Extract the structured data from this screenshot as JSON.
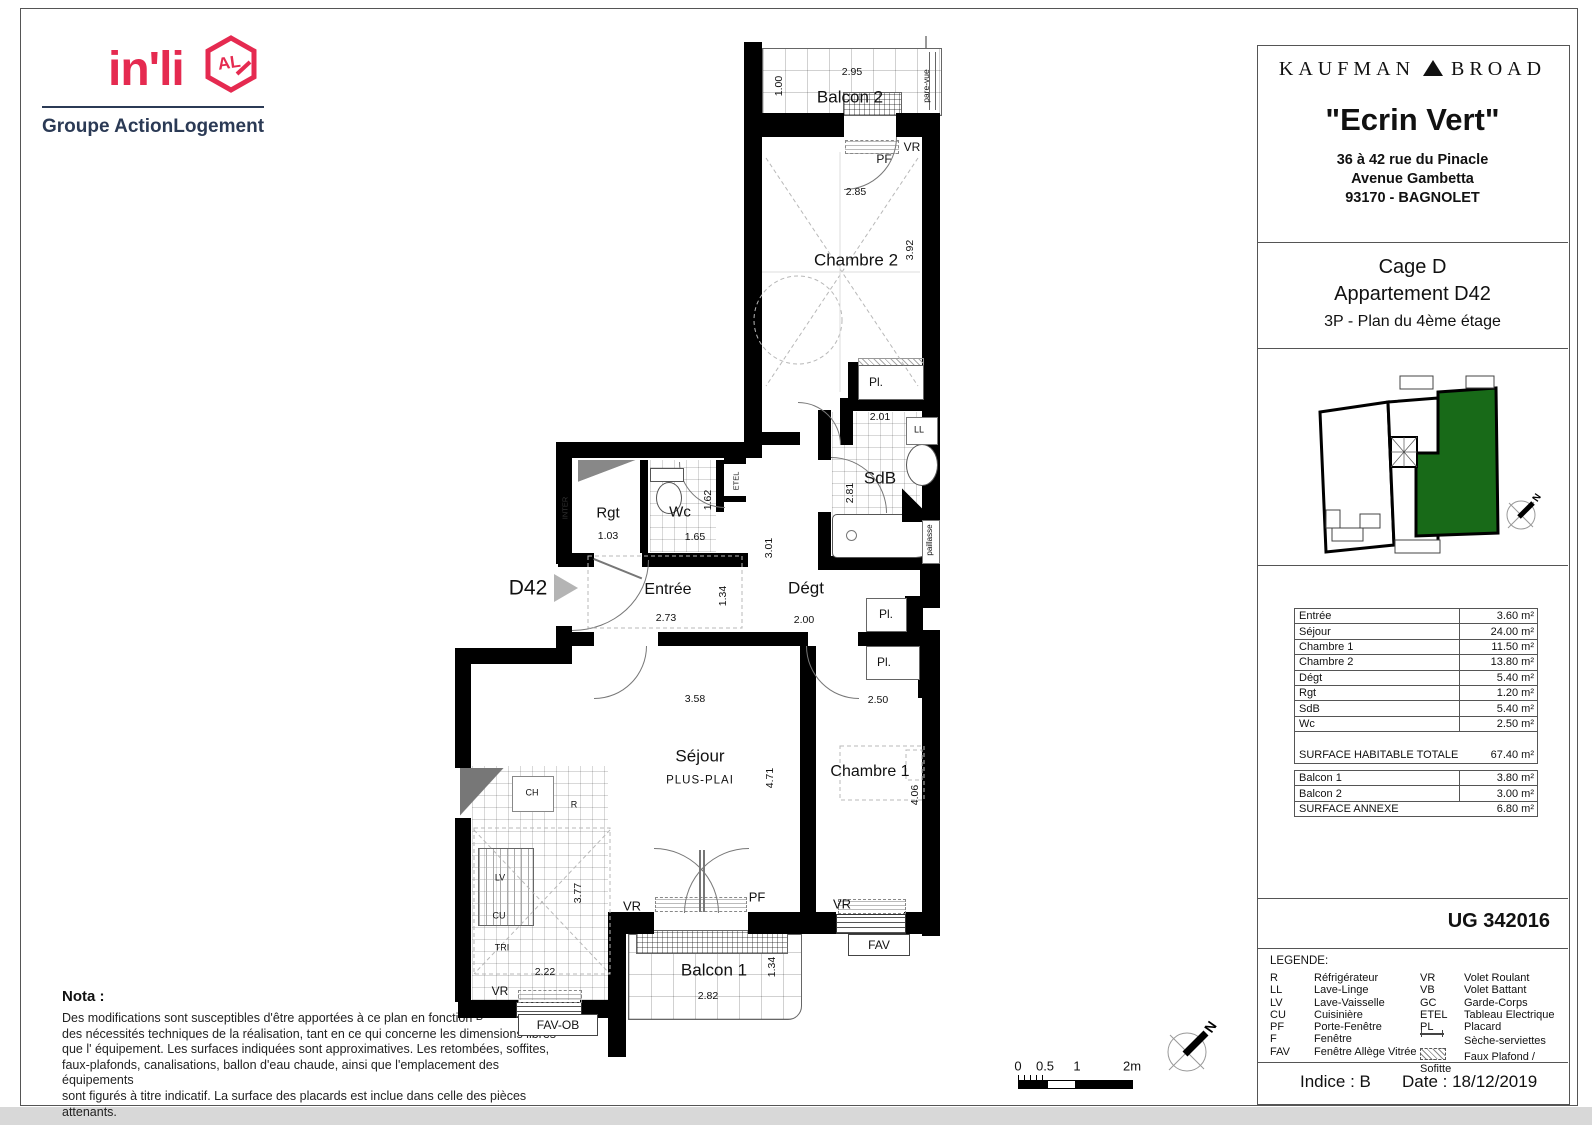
{
  "branding": {
    "inli": "in'li",
    "inli_badge": "AL",
    "inli_sub": "Groupe ActionLogement",
    "accent_pink": "#e52a50",
    "navy": "#2b3a55"
  },
  "header": {
    "developer_left": "KAUFMAN",
    "developer_right": "BROAD",
    "project": "\"Ecrin Vert\"",
    "address1": "36 à 42 rue du Pinacle",
    "address2": "Avenue Gambetta",
    "address3": "93170 - BAGNOLET"
  },
  "unit": {
    "cage": "Cage D",
    "apartment": "Appartement D42",
    "floor": "3P - Plan du 4ème étage"
  },
  "key_plan": {
    "north": "N",
    "highlight_green": "#186a18"
  },
  "surfaces": {
    "rows": [
      {
        "label": "Entrée",
        "value": "3.60 m²"
      },
      {
        "label": "Séjour",
        "value": "24.00 m²"
      },
      {
        "label": "Chambre 1",
        "value": "11.50 m²"
      },
      {
        "label": "Chambre 2",
        "value": "13.80 m²"
      },
      {
        "label": "Dégt",
        "value": "5.40 m²"
      },
      {
        "label": "Rgt",
        "value": "1.20 m²"
      },
      {
        "label": "SdB",
        "value": "5.40 m²"
      },
      {
        "label": "Wc",
        "value": "2.50 m²"
      }
    ],
    "total": {
      "label": "SURFACE HABITABLE TOTALE",
      "value": "67.40 m²"
    },
    "annexe_rows": [
      {
        "label": "Balcon 1",
        "value": "3.80 m²"
      },
      {
        "label": "Balcon 2",
        "value": "3.00 m²"
      }
    ],
    "annexe_total": {
      "label": "SURFACE ANNEXE",
      "value": "6.80 m²"
    }
  },
  "reference": "UG 342016",
  "legend": {
    "title": "LEGENDE:",
    "left": [
      {
        "abbr": "R",
        "label": "Réfrigérateur"
      },
      {
        "abbr": "LL",
        "label": "Lave-Linge"
      },
      {
        "abbr": "LV",
        "label": "Lave-Vaisselle"
      },
      {
        "abbr": "CU",
        "label": "Cuisinière"
      },
      {
        "abbr": "PF",
        "label": "Porte-Fenêtre"
      },
      {
        "abbr": "F",
        "label": "Fenêtre"
      },
      {
        "abbr": "FAV",
        "label": "Fenêtre Allège Vitrée"
      }
    ],
    "right": [
      {
        "abbr": "VR",
        "label": "Volet Roulant"
      },
      {
        "abbr": "VB",
        "label": "Volet Battant"
      },
      {
        "abbr": "GC",
        "label": "Garde-Corps"
      },
      {
        "abbr": "ETEL",
        "label": "Tableau Electrique"
      },
      {
        "abbr": "PL",
        "label": "Placard"
      },
      {
        "abbr": "",
        "label": "Sèche-serviettes"
      },
      {
        "abbr": "",
        "label": "Faux Plafond / Sofitte"
      }
    ]
  },
  "footer": {
    "indice": "Indice : B",
    "date": "Date : 18/12/2019"
  },
  "nota": {
    "title": "Nota :",
    "rev": "B",
    "line1": "Des modifications sont susceptibles d'être apportées à ce plan en fonction",
    "line2": "des nécessités techniques de la réalisation, tant en ce qui concerne les dimensions libres",
    "line3": "que l' équipement. Les surfaces indiquées sont approximatives. Les retombées, soffites,",
    "line4": "faux-plafonds, canalisations, ballon d'eau chaude, ainsi que l'emplacement des équipements",
    "line5": "sont figurés à titre indicatif. La surface des placards est inclue dans celle des pièces attenants."
  },
  "scale_bar": {
    "t0": "0",
    "t05": "0.5",
    "t1": "1",
    "t2": "2m"
  },
  "plan": {
    "unit_label": "D42",
    "north": "N",
    "balcon2": {
      "name": "Balcon 2",
      "dim_w": "2.95",
      "dim_h": "1.00",
      "screen": "pare-vue"
    },
    "chambre2": {
      "name": "Chambre 2",
      "dim_w": "2.85",
      "dim_h": "3.92",
      "vr": "VR",
      "pf": "PF",
      "pl": "Pl."
    },
    "sdb": {
      "name": "SdB",
      "dim_w": "2.01",
      "dim_h": "2.81",
      "ll": "LL",
      "worktop": "paillasse"
    },
    "wc": {
      "name": "Wc",
      "dim_w": "1.65",
      "dim_h": "1.62",
      "etel": "ETEL"
    },
    "rgt": {
      "name": "Rgt",
      "dim_w": "1.03"
    },
    "inter": "INTER",
    "entree": {
      "name": "Entrée",
      "dim_w": "2.73",
      "dim_h": "1.34"
    },
    "degt": {
      "name": "Dégt",
      "dim_w": "2.00",
      "dim_h": "3.01",
      "pl1": "Pl.",
      "pl2": "Pl."
    },
    "sejour": {
      "name": "Séjour",
      "sub": "PLUS-PLAI",
      "dim_w": "3.58",
      "dim_h": "4.71",
      "pf": "PF",
      "vr": "VR"
    },
    "cuisine": {
      "ch": "CH",
      "r": "R",
      "lv": "LV",
      "cu": "CU",
      "tri": "TRI",
      "dim_w": "2.22",
      "dim_h": "3.77",
      "vr": "VR",
      "window": "FAV-OB"
    },
    "chambre1": {
      "name": "Chambre 1",
      "dim_w": "2.50",
      "dim_h": "4.06",
      "vr": "VR",
      "window": "FAV"
    },
    "balcon1": {
      "name": "Balcon 1",
      "dim_w": "2.82",
      "dim_h": "1.34"
    }
  }
}
